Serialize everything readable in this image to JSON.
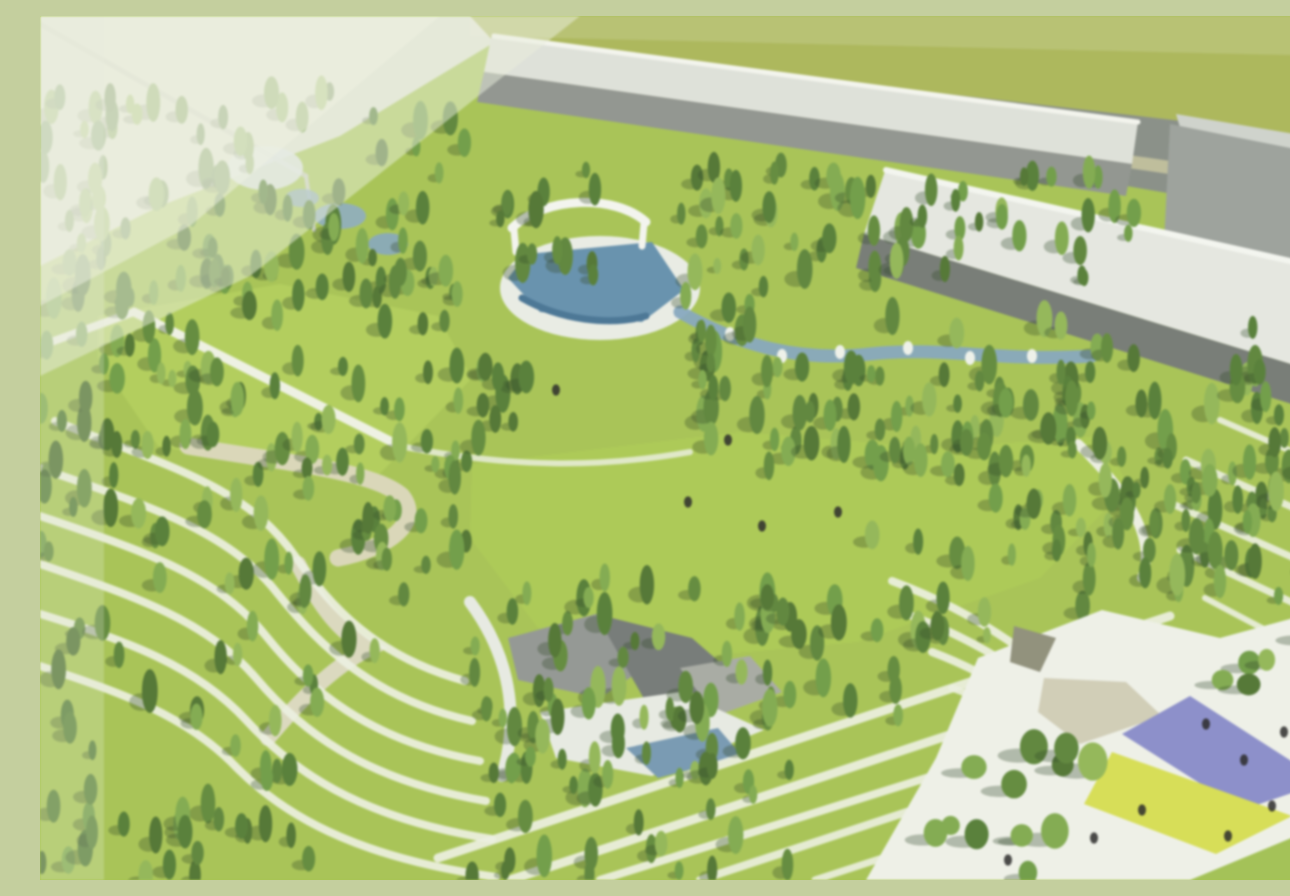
{
  "meta": {
    "title": "aerial-park-rendering",
    "description": "Blurry aerial architectural rendering of a large landscaped park: conifer forests, bright meadows, terraced contour paths, amphitheater pool with white arch, meandering stream, gray industrial buildings along the top edge, and a white plaza with purple and yellow kite-shaped canopies at bottom right."
  },
  "palette": {
    "lawn": "#a2c248",
    "meadow": "#adcd4f",
    "olive_field": "#a8b44f",
    "road": "#838982",
    "roof_light": "#dde0d8",
    "roof_white": "#e4e7e0",
    "wall_gray": "#8b908a",
    "wall_dark": "#6f756f",
    "path_white": "#edf1df",
    "path_beige": "#d9d7bb",
    "water": "#7ea2bd",
    "pool_blue": "#5d8bab",
    "plaza_white": "#eef0e8",
    "canopy_purple": "#8588ca",
    "canopy_yellow": "#d5dd47",
    "canopy_tan": "#cfcbb2",
    "haze": "#eaeedb",
    "people": "#1d1d1d",
    "tree_shadow": "rgba(35,60,25,0.32)",
    "tree_greens": [
      "#4d792c",
      "#5a8630",
      "#68993b",
      "#7aa844",
      "#558130",
      "#486f28",
      "#8db54d"
    ]
  },
  "scene": {
    "width": 1290,
    "height": 864,
    "layers": [
      {
        "type": "rect",
        "name": "lawn-base",
        "x": 0,
        "y": 0,
        "w": 1290,
        "h": 864,
        "fill": "#a2c248"
      },
      {
        "type": "polygon",
        "name": "sky-ground-topleft",
        "pts": "0,0 455,0 455,26 300,120 120,190 0,250",
        "fill": "#dfe4d2"
      },
      {
        "type": "polygon",
        "name": "field-topright",
        "pts": "430,0 1290,0 1290,128 458,30",
        "fill": "#a8b44f"
      },
      {
        "type": "polygon",
        "name": "road-top",
        "pts": "455,26 1290,122 1290,205 458,62",
        "fill": "#838982"
      },
      {
        "type": "polygon",
        "name": "road-median-stripe",
        "pts": "457,48 1290,168 1290,182 457,58",
        "fill": "#c9c79a",
        "opacity": 0.8
      },
      {
        "type": "polygon",
        "name": "building-box-roof",
        "pts": "1136,98 1290,124 1290,150 1142,118",
        "fill": "#cdd1ca"
      },
      {
        "type": "polygon",
        "name": "building-box-front",
        "pts": "1130,108 1290,140 1290,268 1124,226",
        "fill": "#979d97"
      },
      {
        "type": "polygon",
        "name": "warehouse-long-roof",
        "pts": "452,18 1098,106 1092,148 444,56",
        "fill": "#dde0d8"
      },
      {
        "type": "line",
        "name": "warehouse-long-ridge",
        "x1": 454,
        "y1": 20,
        "x2": 1098,
        "y2": 106,
        "stroke": "#f3f5ee",
        "w": 5
      },
      {
        "type": "polygon",
        "name": "warehouse-long-front",
        "pts": "444,56 1092,148 1086,180 437,86",
        "fill": "#8b908a"
      },
      {
        "type": "polygon",
        "name": "warehouse-big-roof",
        "pts": "846,152 1290,252 1290,360 824,218",
        "fill": "#e4e7e0"
      },
      {
        "type": "line",
        "name": "warehouse-big-gutter",
        "x1": 846,
        "y1": 154,
        "x2": 1290,
        "y2": 254,
        "stroke": "#f4f6f0",
        "w": 6
      },
      {
        "type": "polygon",
        "name": "warehouse-big-front",
        "pts": "824,218 1290,360 1290,400 816,252",
        "fill": "#6f756f"
      },
      {
        "type": "line",
        "name": "cable-topleft",
        "x1": 0,
        "y1": 8,
        "x2": 266,
        "y2": 160,
        "stroke": "#c6ccba",
        "w": 5,
        "opacity": 0.9
      },
      {
        "type": "line",
        "name": "pole-topleft",
        "x1": 266,
        "y1": 160,
        "x2": 274,
        "y2": 214,
        "stroke": "#c6ccba",
        "w": 4
      },
      {
        "type": "ellipse",
        "name": "glass-pavilion",
        "cx": 225,
        "cy": 152,
        "rx": 38,
        "ry": 22,
        "fill": "#dfe7ea",
        "opacity": 0.9
      },
      {
        "type": "polygon",
        "name": "meadow-left",
        "pts": "58,300 240,268 398,300 432,362 330,468 118,430 58,342",
        "fill": "#adcd4f"
      },
      {
        "type": "polygon",
        "name": "meadow-central",
        "pts": "432,448 700,416 900,432 1062,420 1088,470 1000,562 818,626 640,642 498,612 430,522",
        "fill": "#a7c848"
      },
      {
        "type": "path",
        "name": "path-hook",
        "d": "M 148,430 C 240,446 332,454 362,480 C 382,506 350,532 298,542",
        "stroke": "#d8d5b5",
        "w": 17
      },
      {
        "type": "line",
        "name": "path-meadow-diagonal",
        "x1": 94,
        "y1": 296,
        "x2": 360,
        "y2": 430,
        "stroke": "#eef1e2",
        "w": 9
      },
      {
        "type": "line",
        "name": "path-meadow-left",
        "x1": 0,
        "y1": 330,
        "x2": 94,
        "y2": 296,
        "stroke": "#eef1e2",
        "w": 8
      },
      {
        "type": "path",
        "name": "path-meadow-top",
        "d": "M 360,430 C 470,452 560,452 650,436",
        "stroke": "#e9eddc",
        "w": 6,
        "opacity": 0.85
      },
      {
        "type": "ellipse",
        "name": "water-garden-pond-1",
        "cx": 300,
        "cy": 200,
        "rx": 26,
        "ry": 13,
        "fill": "#86a8c0",
        "opacity": 0.9
      },
      {
        "type": "ellipse",
        "name": "water-garden-pond-2",
        "cx": 348,
        "cy": 228,
        "rx": 20,
        "ry": 11,
        "fill": "#7ea2bd",
        "opacity": 0.9
      },
      {
        "type": "ellipse",
        "name": "water-garden-pond-3",
        "cx": 262,
        "cy": 182,
        "rx": 17,
        "ry": 9,
        "fill": "#86a8c0",
        "opacity": 0.85
      },
      {
        "type": "ellipse",
        "name": "amphitheater-plaza",
        "cx": 560,
        "cy": 272,
        "rx": 100,
        "ry": 52,
        "fill": "#e9ece4"
      },
      {
        "type": "polygon",
        "name": "amphitheater-pool",
        "pts": "487,238 612,226 644,274 602,306 500,296 468,262",
        "fill": "#5d8bab"
      },
      {
        "type": "path",
        "name": "amphitheater-pool-edge",
        "d": "M 482,282 C 520,304 570,310 606,300",
        "stroke": "#3e6e92",
        "w": 7
      },
      {
        "type": "path",
        "name": "amphitheater-arch",
        "d": "M 472,212 C 505,180 575,178 606,206",
        "stroke": "#f3f5ef",
        "w": 9
      },
      {
        "type": "line",
        "name": "arch-leg-left",
        "x1": 474,
        "y1": 214,
        "x2": 476,
        "y2": 236,
        "stroke": "#f3f5ef",
        "w": 7
      },
      {
        "type": "line",
        "name": "arch-leg-right",
        "x1": 604,
        "y1": 208,
        "x2": 602,
        "y2": 230,
        "stroke": "#f3f5ef",
        "w": 7
      },
      {
        "type": "path",
        "name": "stream",
        "d": "M 640,296 C 700,330 760,346 830,338 C 900,330 960,346 1052,340",
        "stroke": "#7ea2bd",
        "w": 13,
        "opacity": 0.95
      },
      {
        "type": "dots",
        "name": "stream-rocks",
        "color": "#eef1ea",
        "size": 5,
        "pts": [
          [
            690,
            318
          ],
          [
            742,
            340
          ],
          [
            800,
            336
          ],
          [
            868,
            332
          ],
          [
            930,
            342
          ],
          [
            992,
            340
          ]
        ]
      },
      {
        "type": "polygon",
        "name": "pavilion-roof-a",
        "pts": "468,622 556,598 622,640 560,682 478,664",
        "fill": "#8e928f"
      },
      {
        "type": "polygon",
        "name": "pavilion-roof-b",
        "pts": "556,598 652,622 700,664 608,690",
        "fill": "#6e7371"
      },
      {
        "type": "polygon",
        "name": "pavilion-roof-c",
        "pts": "640,652 710,640 742,676 676,700",
        "fill": "#a3a79f"
      },
      {
        "type": "polygon",
        "name": "pavilion-court",
        "pts": "500,696 640,676 724,714 612,760 516,742",
        "fill": "#e7eae2"
      },
      {
        "type": "polygon",
        "name": "pavilion-pond",
        "pts": "586,732 678,712 702,740 618,762",
        "fill": "#6f94b0"
      },
      {
        "type": "path",
        "name": "path-pavilion-west",
        "d": "M 430,586 C 470,640 480,700 462,760",
        "stroke": "#e7eae2",
        "w": 12
      },
      {
        "type": "path",
        "name": "path-wide-junction-down",
        "d": "M 258,548 C 280,590 300,618 330,632 C 290,652 255,690 228,722",
        "stroke": "#d9d7bb",
        "w": 16
      },
      {
        "type": "path",
        "name": "terrace-a-1",
        "d": "M 15,405 C 120,448 205,468 255,540 C 292,592 335,640 425,665",
        "stroke": "#ecf0df",
        "w": 8,
        "opacity": 0.92
      },
      {
        "type": "path",
        "name": "terrace-a-2",
        "d": "M 0,452 C 108,490 188,514 238,578 C 280,630 332,682 432,705",
        "stroke": "#ecf0df",
        "w": 8,
        "opacity": 0.92
      },
      {
        "type": "path",
        "name": "terrace-a-3",
        "d": "M 0,500 C 100,534 176,558 226,620 C 268,672 326,724 440,745",
        "stroke": "#ecf0df",
        "w": 8,
        "opacity": 0.92
      },
      {
        "type": "path",
        "name": "terrace-a-4",
        "d": "M 0,548 C 94,580 166,604 216,662 C 258,712 322,764 446,785",
        "stroke": "#ecf0df",
        "w": 8,
        "opacity": 0.92
      },
      {
        "type": "path",
        "name": "terrace-a-5",
        "d": "M 0,598 C 88,625 156,650 206,704 C 250,752 316,802 452,823",
        "stroke": "#ecf0df",
        "w": 8,
        "opacity": 0.92
      },
      {
        "type": "path",
        "name": "terrace-a-6",
        "d": "M 0,650 C 80,676 148,700 197,752 C 241,796 311,841 456,861",
        "stroke": "#ecf0df",
        "w": 8,
        "opacity": 0.92
      },
      {
        "type": "path",
        "name": "terrace-b-1",
        "d": "M 852,565 C 925,592 988,632 1040,684 C 1082,726 1130,764 1185,788",
        "stroke": "#ecf0df",
        "w": 8,
        "opacity": 0.92
      },
      {
        "type": "path",
        "name": "terrace-b-2",
        "d": "M 872,600 C 940,626 1000,664 1048,714 C 1088,754 1136,792 1190,814",
        "stroke": "#ecf0df",
        "w": 8,
        "opacity": 0.92
      },
      {
        "type": "path",
        "name": "terrace-b-3",
        "d": "M 892,636 C 955,660 1010,696 1056,744 C 1094,782 1140,818 1195,840",
        "stroke": "#ecf0df",
        "w": 8,
        "opacity": 0.92
      },
      {
        "type": "path",
        "name": "terrace-b-4",
        "d": "M 912,672 C 972,694 1024,728 1066,774 C 1102,810 1146,846 1200,862",
        "stroke": "#ecf0df",
        "w": 7,
        "opacity": 0.9
      },
      {
        "type": "line",
        "name": "lawn-stripe-c-1",
        "x1": 398,
        "y1": 842,
        "x2": 1130,
        "y2": 600,
        "stroke": "#ecf0df",
        "w": 9,
        "opacity": 0.92
      },
      {
        "type": "line",
        "name": "lawn-stripe-c-2",
        "x1": 470,
        "y1": 864,
        "x2": 1185,
        "y2": 628,
        "stroke": "#ecf0df",
        "w": 9,
        "opacity": 0.92
      },
      {
        "type": "line",
        "name": "lawn-stripe-c-3",
        "x1": 560,
        "y1": 864,
        "x2": 1238,
        "y2": 652,
        "stroke": "#ecf0df",
        "w": 8,
        "opacity": 0.92
      },
      {
        "type": "line",
        "name": "lawn-stripe-c-4",
        "x1": 660,
        "y1": 864,
        "x2": 1280,
        "y2": 660,
        "stroke": "#ecf0df",
        "w": 8,
        "opacity": 0.9
      },
      {
        "type": "line",
        "name": "lawn-stripe-c-5",
        "x1": 775,
        "y1": 864,
        "x2": 1290,
        "y2": 696,
        "stroke": "#ecf0df",
        "w": 7,
        "opacity": 0.9
      },
      {
        "type": "line",
        "name": "slope-stripe-d-0",
        "x1": 1180,
        "y1": 404,
        "x2": 1290,
        "y2": 452,
        "stroke": "#ecf0df",
        "w": 6,
        "opacity": 0.9
      },
      {
        "type": "line",
        "name": "slope-stripe-d-1",
        "x1": 1146,
        "y1": 444,
        "x2": 1290,
        "y2": 508,
        "stroke": "#ecf0df",
        "w": 7,
        "opacity": 0.9
      },
      {
        "type": "line",
        "name": "slope-stripe-d-2",
        "x1": 1128,
        "y1": 486,
        "x2": 1290,
        "y2": 558,
        "stroke": "#ecf0df",
        "w": 7,
        "opacity": 0.9
      },
      {
        "type": "line",
        "name": "slope-stripe-d-3",
        "x1": 1140,
        "y1": 534,
        "x2": 1290,
        "y2": 604,
        "stroke": "#ecf0df",
        "w": 7,
        "opacity": 0.9
      },
      {
        "type": "line",
        "name": "slope-stripe-d-4",
        "x1": 1165,
        "y1": 582,
        "x2": 1290,
        "y2": 648,
        "stroke": "#ecf0df",
        "w": 6,
        "opacity": 0.9
      },
      {
        "type": "path",
        "name": "path-east",
        "d": "M 1038,428 C 1082,470 1118,520 1102,562",
        "stroke": "#ecefe0",
        "w": 10
      },
      {
        "type": "forest",
        "name": "forest-topleft",
        "x": 0,
        "y": 75,
        "w": 450,
        "h": 205,
        "n": 85,
        "seed": 11
      },
      {
        "type": "forest",
        "name": "forest-amphi-left",
        "x": 445,
        "y": 150,
        "w": 120,
        "h": 112,
        "n": 14,
        "seed": 21
      },
      {
        "type": "forest",
        "name": "forest-under-warehouse",
        "x": 640,
        "y": 148,
        "w": 455,
        "h": 115,
        "n": 60,
        "seed": 22
      },
      {
        "type": "forest",
        "name": "forest-under-bigroof",
        "x": 830,
        "y": 295,
        "w": 460,
        "h": 255,
        "n": 92,
        "seed": 33
      },
      {
        "type": "forest",
        "name": "forest-left-column",
        "x": 0,
        "y": 255,
        "w": 155,
        "h": 330,
        "n": 42,
        "seed": 44
      },
      {
        "type": "forest",
        "name": "forest-midleft",
        "x": 158,
        "y": 330,
        "w": 272,
        "h": 255,
        "n": 58,
        "seed": 55
      },
      {
        "type": "forest",
        "name": "forest-amphi-west",
        "x": 430,
        "y": 250,
        "w": 60,
        "h": 180,
        "n": 10,
        "seed": 61
      },
      {
        "type": "forest",
        "name": "forest-amphi-east",
        "x": 645,
        "y": 250,
        "w": 105,
        "h": 105,
        "n": 14,
        "seed": 62
      },
      {
        "type": "forest",
        "name": "forest-stream-band",
        "x": 640,
        "y": 350,
        "w": 420,
        "h": 105,
        "n": 46,
        "seed": 77
      },
      {
        "type": "forest",
        "name": "forest-meadow-topedge",
        "x": 60,
        "y": 253,
        "w": 360,
        "h": 55,
        "n": 20,
        "seed": 140
      },
      {
        "type": "forest",
        "name": "forest-meadow-east",
        "x": 900,
        "y": 380,
        "w": 170,
        "h": 80,
        "n": 15,
        "seed": 150
      },
      {
        "type": "forest",
        "name": "forest-right-mid",
        "x": 1040,
        "y": 420,
        "w": 250,
        "h": 170,
        "n": 36,
        "seed": 99
      },
      {
        "type": "forest",
        "name": "forest-bottom-center",
        "x": 432,
        "y": 560,
        "w": 330,
        "h": 300,
        "n": 85,
        "seed": 88
      },
      {
        "type": "forest",
        "name": "forest-terrace-scatter",
        "x": 0,
        "y": 596,
        "w": 360,
        "h": 268,
        "n": 30,
        "seed": 101
      },
      {
        "type": "forest",
        "name": "forest-plaza-west",
        "x": 700,
        "y": 560,
        "w": 250,
        "h": 140,
        "n": 28,
        "seed": 112
      },
      {
        "type": "forest",
        "name": "forest-meadow-singles",
        "x": 300,
        "y": 430,
        "w": 140,
        "h": 120,
        "n": 6,
        "seed": 123
      },
      {
        "type": "forest",
        "name": "forest-bottomleft-corner",
        "x": 0,
        "y": 756,
        "w": 210,
        "h": 108,
        "n": 18,
        "seed": 170
      },
      {
        "type": "polygon",
        "name": "plaza",
        "pts": "938,642 1062,594 1180,622 1290,592 1290,864 826,864 896,742",
        "fill": "#eef0e8"
      },
      {
        "type": "polygon",
        "name": "canopy-dark",
        "pts": "974,610 1016,622 1000,656 970,646",
        "fill": "#8a8a74"
      },
      {
        "type": "polygon",
        "name": "canopy-tan",
        "pts": "1004,662 1086,666 1122,700 1040,728 998,696",
        "fill": "#cfcbb2"
      },
      {
        "type": "polygon",
        "name": "canopy-purple",
        "pts": "1082,718 1150,680 1284,766 1202,794",
        "fill": "#8588ca"
      },
      {
        "type": "polygon",
        "name": "canopy-yellow",
        "pts": "1072,736 1252,800 1176,838 1044,788",
        "fill": "#d5dd47"
      },
      {
        "type": "polygon",
        "name": "lawn-corner-bottomright",
        "pts": "1150,864 1290,806 1290,864",
        "fill": "#9dbf48"
      },
      {
        "type": "forest",
        "name": "palm-trees-plaza",
        "x": 1120,
        "y": 592,
        "w": 170,
        "h": 90,
        "n": 6,
        "seed": 180,
        "round": true,
        "minW": 8,
        "maxW": 12
      },
      {
        "type": "forest",
        "name": "trees-over-plaza",
        "x": 880,
        "y": 718,
        "w": 185,
        "h": 146,
        "n": 13,
        "seed": 160,
        "round": true,
        "minW": 9,
        "maxW": 15
      },
      {
        "type": "dots",
        "name": "people",
        "color": "#1d1d1d",
        "size": 4,
        "opacity": 0.85,
        "pts": [
          [
            1166,
            708
          ],
          [
            1204,
            744
          ],
          [
            1244,
            716
          ],
          [
            1264,
            750
          ],
          [
            1232,
            790
          ],
          [
            1188,
            820
          ],
          [
            1282,
            822
          ],
          [
            1102,
            794
          ],
          [
            1054,
            822
          ],
          [
            968,
            844
          ],
          [
            648,
            486
          ],
          [
            722,
            510
          ],
          [
            798,
            496
          ],
          [
            516,
            374
          ],
          [
            688,
            424
          ]
        ]
      },
      {
        "type": "polygon",
        "name": "glare-topleft-outer",
        "pts": "0,0 540,0 210,260 0,360",
        "fill": "#eaeedb",
        "opacity": 0.5
      },
      {
        "type": "polygon",
        "name": "glare-topleft-inner",
        "pts": "0,0 400,0 150,210 0,290",
        "fill": "#eff1e2",
        "opacity": 0.5
      },
      {
        "type": "rect",
        "name": "glare-left-band",
        "x": 0,
        "y": 0,
        "w": 64,
        "h": 864,
        "fill": "#e9edda",
        "opacity": 0.25
      },
      {
        "type": "polygon",
        "name": "glare-top-band",
        "pts": "430,0 1290,0 1290,40 430,20",
        "fill": "#eef0df",
        "opacity": 0.18
      },
      {
        "type": "rect",
        "name": "glare-veil",
        "x": 0,
        "y": 0,
        "w": 1290,
        "h": 864,
        "fill": "#f3f5e9",
        "opacity": 0.08
      }
    ]
  }
}
